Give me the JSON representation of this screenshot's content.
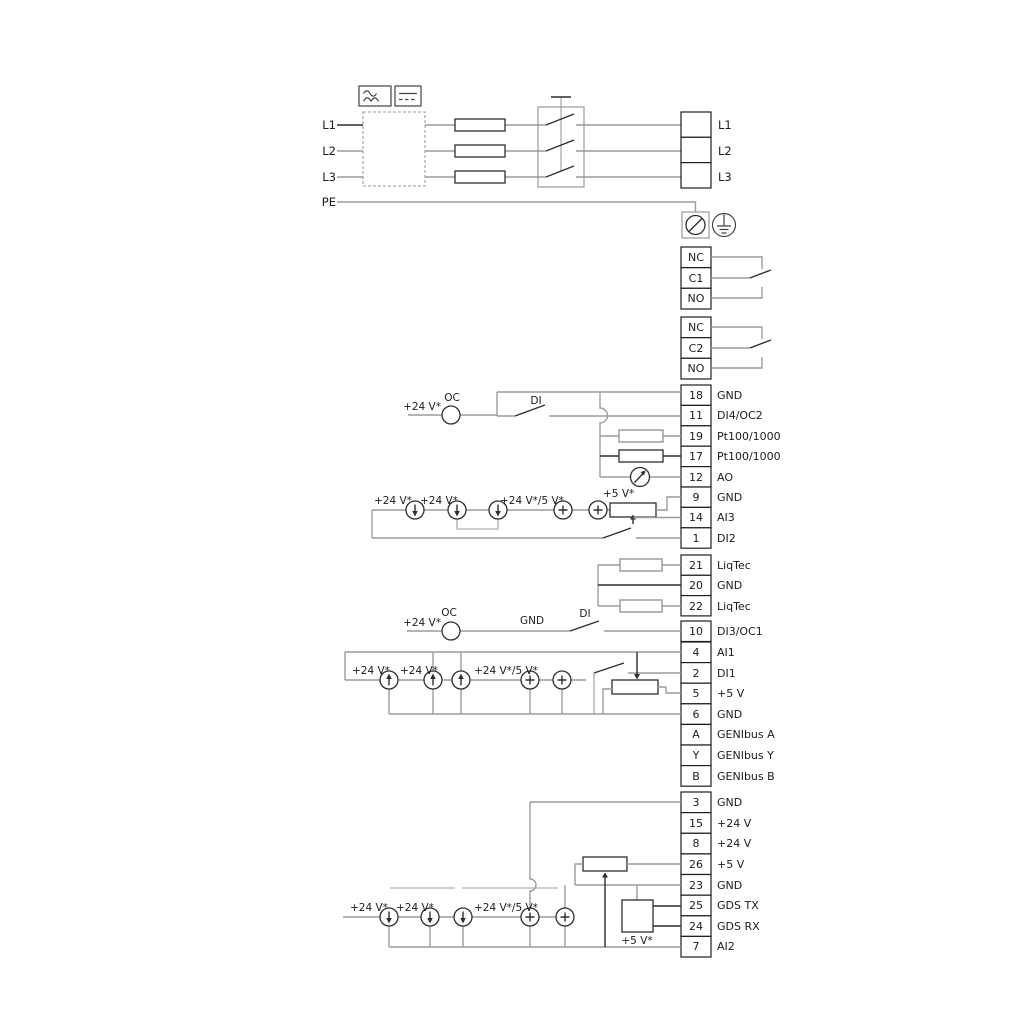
{
  "power": {
    "in": [
      "L1",
      "L2",
      "L3",
      "PE"
    ],
    "out": [
      "L1",
      "L2",
      "L3"
    ]
  },
  "relay1": {
    "rows": [
      "NC",
      "C1",
      "NO"
    ]
  },
  "relay2": {
    "rows": [
      "NC",
      "C2",
      "NO"
    ]
  },
  "g1": [
    {
      "n": "18",
      "l": "GND"
    },
    {
      "n": "11",
      "l": "DI4/OC2"
    },
    {
      "n": "19",
      "l": "Pt100/1000"
    },
    {
      "n": "17",
      "l": "Pt100/1000"
    },
    {
      "n": "12",
      "l": "AO"
    },
    {
      "n": "9",
      "l": "GND"
    },
    {
      "n": "14",
      "l": "AI3"
    },
    {
      "n": "1",
      "l": "DI2"
    }
  ],
  "liqtec": [
    {
      "n": "21",
      "l": "LiqTec"
    },
    {
      "n": "20",
      "l": "GND"
    },
    {
      "n": "22",
      "l": "LiqTec"
    }
  ],
  "di3": {
    "n": "10",
    "l": "DI3/OC1"
  },
  "g2": [
    {
      "n": "4",
      "l": "AI1"
    },
    {
      "n": "2",
      "l": "DI1"
    },
    {
      "n": "5",
      "l": "+5 V"
    },
    {
      "n": "6",
      "l": "GND"
    },
    {
      "n": "A",
      "l": "GENIbus A"
    },
    {
      "n": "Y",
      "l": "GENIbus Y"
    },
    {
      "n": "B",
      "l": "GENIbus B"
    }
  ],
  "g3": [
    {
      "n": "3",
      "l": "GND"
    },
    {
      "n": "15",
      "l": "+24 V"
    },
    {
      "n": "8",
      "l": "+24 V"
    },
    {
      "n": "26",
      "l": "+5 V"
    },
    {
      "n": "23",
      "l": "GND"
    },
    {
      "n": "25",
      "l": "GDS TX"
    },
    {
      "n": "24",
      "l": "GDS RX"
    },
    {
      "n": "7",
      "l": "AI2"
    }
  ],
  "labels": {
    "v24": "+24 V*",
    "v24v5": "+24 V*/5 V*",
    "v5": "+5 V*",
    "oc": "OC",
    "di": "DI",
    "gnd": "GND"
  },
  "colors": {
    "wire": "#9c9c9c",
    "ink": "#2e2e2e"
  }
}
